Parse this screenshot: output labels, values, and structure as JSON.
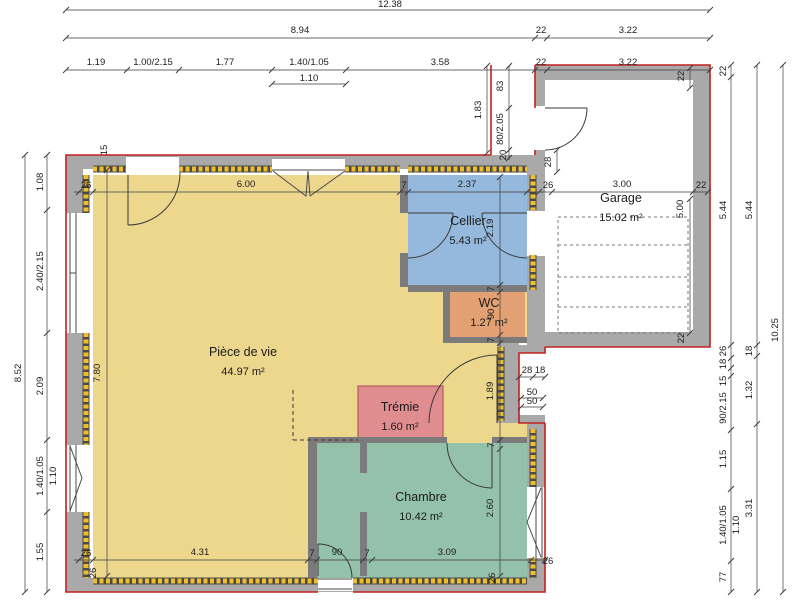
{
  "plan_type": "floor-plan",
  "colors": {
    "outline": "#c42020",
    "wall": "#a9a9a9",
    "partition": "#7b7b7b",
    "insulation": "#edbe2e",
    "insulation_base": "#4a4a4a",
    "floor_living": "#ecd78d",
    "floor_cellier": "#94b9dc",
    "floor_wc": "#e2a073",
    "floor_tremie": "#df8d8f",
    "floor_chambre": "#93c1a9",
    "floor_garage": "#ffffff",
    "dim_line": "#3a3a3a"
  },
  "rooms": [
    {
      "name": "Pièce de vie",
      "area": "44.97 m²",
      "x": 243,
      "y": 356
    },
    {
      "name": "Cellier",
      "area": "5.43 m²",
      "x": 468,
      "y": 225
    },
    {
      "name": "WC",
      "area": "1.27 m²",
      "x": 489,
      "y": 307
    },
    {
      "name": "Trémie",
      "area": "1.60 m²",
      "x": 400,
      "y": 411
    },
    {
      "name": "Chambre",
      "area": "10.42 m²",
      "x": 421,
      "y": 501
    },
    {
      "name": "Garage",
      "area": "15.02 m²",
      "x": 621,
      "y": 202
    }
  ],
  "dims": [
    {
      "t": "12.38",
      "x": 390,
      "y": 7
    },
    {
      "t": "8.94",
      "x": 300,
      "y": 33
    },
    {
      "t": "22",
      "x": 541,
      "y": 33
    },
    {
      "t": "3.22",
      "x": 628,
      "y": 33
    },
    {
      "t": "1.19",
      "x": 96,
      "y": 65
    },
    {
      "t": "1.00/2.15",
      "x": 153,
      "y": 65
    },
    {
      "t": "1.77",
      "x": 225,
      "y": 65
    },
    {
      "t": "1.40/1.05",
      "x": 309,
      "y": 65
    },
    {
      "t": "3.58",
      "x": 440,
      "y": 65
    },
    {
      "t": "22",
      "x": 541,
      "y": 65
    },
    {
      "t": "3.22",
      "x": 628,
      "y": 65
    },
    {
      "t": "1.10",
      "x": 309,
      "y": 81
    },
    {
      "t": "8.52",
      "x": 21,
      "y": 373,
      "r": -90
    },
    {
      "t": "1.08",
      "x": 43,
      "y": 182,
      "r": -90
    },
    {
      "t": "2.40/2.15",
      "x": 43,
      "y": 271,
      "r": -90
    },
    {
      "t": "2.09",
      "x": 43,
      "y": 386,
      "r": -90
    },
    {
      "t": "1.40/1.05",
      "x": 43,
      "y": 476,
      "r": -90
    },
    {
      "t": "1.10",
      "x": 56,
      "y": 476,
      "r": -90
    },
    {
      "t": "1.55",
      "x": 43,
      "y": 552,
      "r": -90
    },
    {
      "t": "22",
      "x": 726,
      "y": 71,
      "r": -90,
      "s": 8
    },
    {
      "t": "5.44",
      "x": 726,
      "y": 210,
      "r": -90
    },
    {
      "t": "26",
      "x": 726,
      "y": 351,
      "r": -90,
      "s": 8
    },
    {
      "t": "18",
      "x": 726,
      "y": 364,
      "r": -90,
      "s": 8
    },
    {
      "t": "15",
      "x": 726,
      "y": 381,
      "r": -90,
      "s": 8
    },
    {
      "t": "90/2.15",
      "x": 726,
      "y": 408,
      "r": -90
    },
    {
      "t": "1.15",
      "x": 726,
      "y": 459,
      "r": -90
    },
    {
      "t": "1.40/1.05",
      "x": 726,
      "y": 525,
      "r": -90
    },
    {
      "t": "1.10",
      "x": 739,
      "y": 525,
      "r": -90
    },
    {
      "t": "77",
      "x": 726,
      "y": 577,
      "r": -90,
      "s": 8
    },
    {
      "t": "5.44",
      "x": 752,
      "y": 210,
      "r": -90
    },
    {
      "t": "18",
      "x": 752,
      "y": 351,
      "r": -90,
      "s": 8
    },
    {
      "t": "1.32",
      "x": 752,
      "y": 390,
      "r": -90
    },
    {
      "t": "3.31",
      "x": 752,
      "y": 508,
      "r": -90
    },
    {
      "t": "10.25",
      "x": 778,
      "y": 330,
      "r": -90
    },
    {
      "t": "1.83",
      "x": 481,
      "y": 110,
      "r": -90
    },
    {
      "t": "83",
      "x": 503,
      "y": 86,
      "r": -90,
      "s": 8
    },
    {
      "t": "80/2.05",
      "x": 503,
      "y": 129,
      "r": -90,
      "s": 8
    },
    {
      "t": "20",
      "x": 506,
      "y": 155,
      "r": -90,
      "s": 8
    },
    {
      "t": "28",
      "x": 551,
      "y": 162,
      "r": -90,
      "s": 8
    },
    {
      "t": "22",
      "x": 684,
      "y": 76,
      "r": -90,
      "s": 8
    },
    {
      "t": "26",
      "x": 86,
      "y": 188,
      "s": 8
    },
    {
      "t": "6.00",
      "x": 246,
      "y": 187
    },
    {
      "t": "7",
      "x": 404,
      "y": 188,
      "s": 8
    },
    {
      "t": "2.37",
      "x": 467,
      "y": 187
    },
    {
      "t": "26",
      "x": 548,
      "y": 188,
      "s": 8
    },
    {
      "t": "3.00",
      "x": 622,
      "y": 187
    },
    {
      "t": "22",
      "x": 701,
      "y": 188,
      "s": 8
    },
    {
      "t": "5.00",
      "x": 683,
      "y": 209,
      "r": -90
    },
    {
      "t": "22",
      "x": 684,
      "y": 338,
      "r": -90,
      "s": 8
    },
    {
      "t": "15",
      "x": 107,
      "y": 150,
      "r": -90,
      "s": 8
    },
    {
      "t": "2.19",
      "x": 493,
      "y": 228,
      "r": -90
    },
    {
      "t": "7",
      "x": 494,
      "y": 289,
      "r": -90,
      "s": 8
    },
    {
      "t": "90",
      "x": 494,
      "y": 314,
      "r": -90,
      "s": 8
    },
    {
      "t": "7",
      "x": 494,
      "y": 340,
      "r": -90,
      "s": 8
    },
    {
      "t": "1.89",
      "x": 493,
      "y": 391,
      "r": -90
    },
    {
      "t": "7",
      "x": 494,
      "y": 445,
      "r": -90,
      "s": 8
    },
    {
      "t": "2.60",
      "x": 493,
      "y": 508,
      "r": -90
    },
    {
      "t": "26",
      "x": 495,
      "y": 578,
      "r": -90,
      "s": 8
    },
    {
      "t": "7.80",
      "x": 100,
      "y": 373,
      "r": -90
    },
    {
      "t": "28",
      "x": 527,
      "y": 373,
      "s": 8
    },
    {
      "t": "18",
      "x": 540,
      "y": 373,
      "s": 8
    },
    {
      "t": "50",
      "x": 532,
      "y": 395,
      "s": 8
    },
    {
      "t": "50",
      "x": 532,
      "y": 404,
      "s": 8
    },
    {
      "t": "26",
      "x": 86,
      "y": 556,
      "s": 8
    },
    {
      "t": "4.31",
      "x": 200,
      "y": 555
    },
    {
      "t": "7",
      "x": 312,
      "y": 556,
      "s": 8
    },
    {
      "t": "90",
      "x": 337,
      "y": 555,
      "s": 8
    },
    {
      "t": "7",
      "x": 367,
      "y": 556,
      "s": 8
    },
    {
      "t": "3.09",
      "x": 447,
      "y": 555
    },
    {
      "t": "26",
      "x": 96,
      "y": 573,
      "r": -90,
      "s": 8
    },
    {
      "t": "26",
      "x": 548,
      "y": 564,
      "s": 8
    }
  ]
}
